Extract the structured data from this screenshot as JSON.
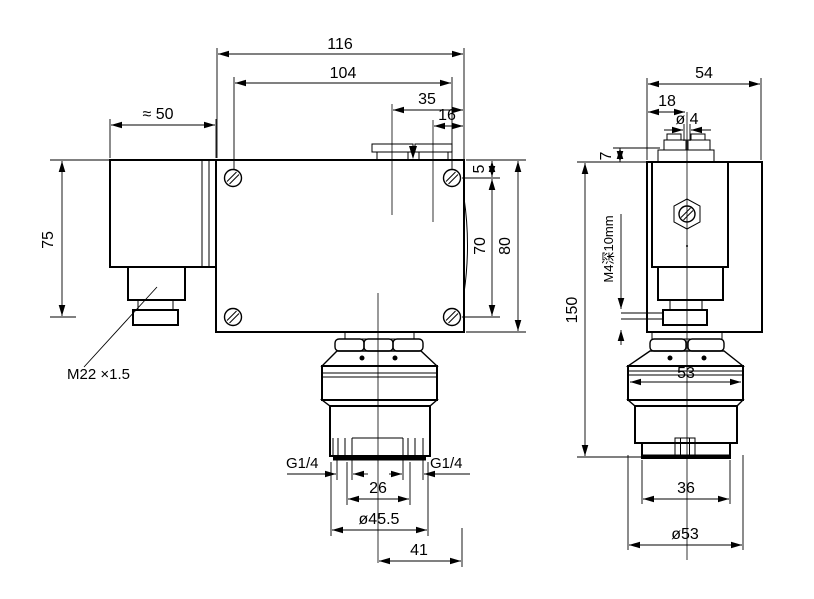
{
  "drawing": {
    "kind": "technical-drawing",
    "background_color": "#ffffff",
    "line_color": "#000000",
    "labels": {
      "front": {
        "dim_116": "116",
        "dim_104": "104",
        "dim_35": "35",
        "dim_16": "16",
        "dim_50": "≈ 50",
        "dim_75": "75",
        "dim_5": "5",
        "dim_70": "70",
        "dim_80": "80",
        "thread_m22": "M22 ×1.5",
        "g14_left": "G1/4",
        "g14_right": "G1/4",
        "dim_26": "26",
        "dim_45_5": "ø45.5",
        "dim_41": "41"
      },
      "side": {
        "dim_54": "54",
        "dim_18": "18",
        "dim_4": "ø 4",
        "dim_7": "7",
        "dim_150": "150",
        "note_m4": "M4深10mm",
        "dim_53_flats": "53",
        "dim_36": "36",
        "dim_53_dia": "ø53"
      }
    }
  }
}
